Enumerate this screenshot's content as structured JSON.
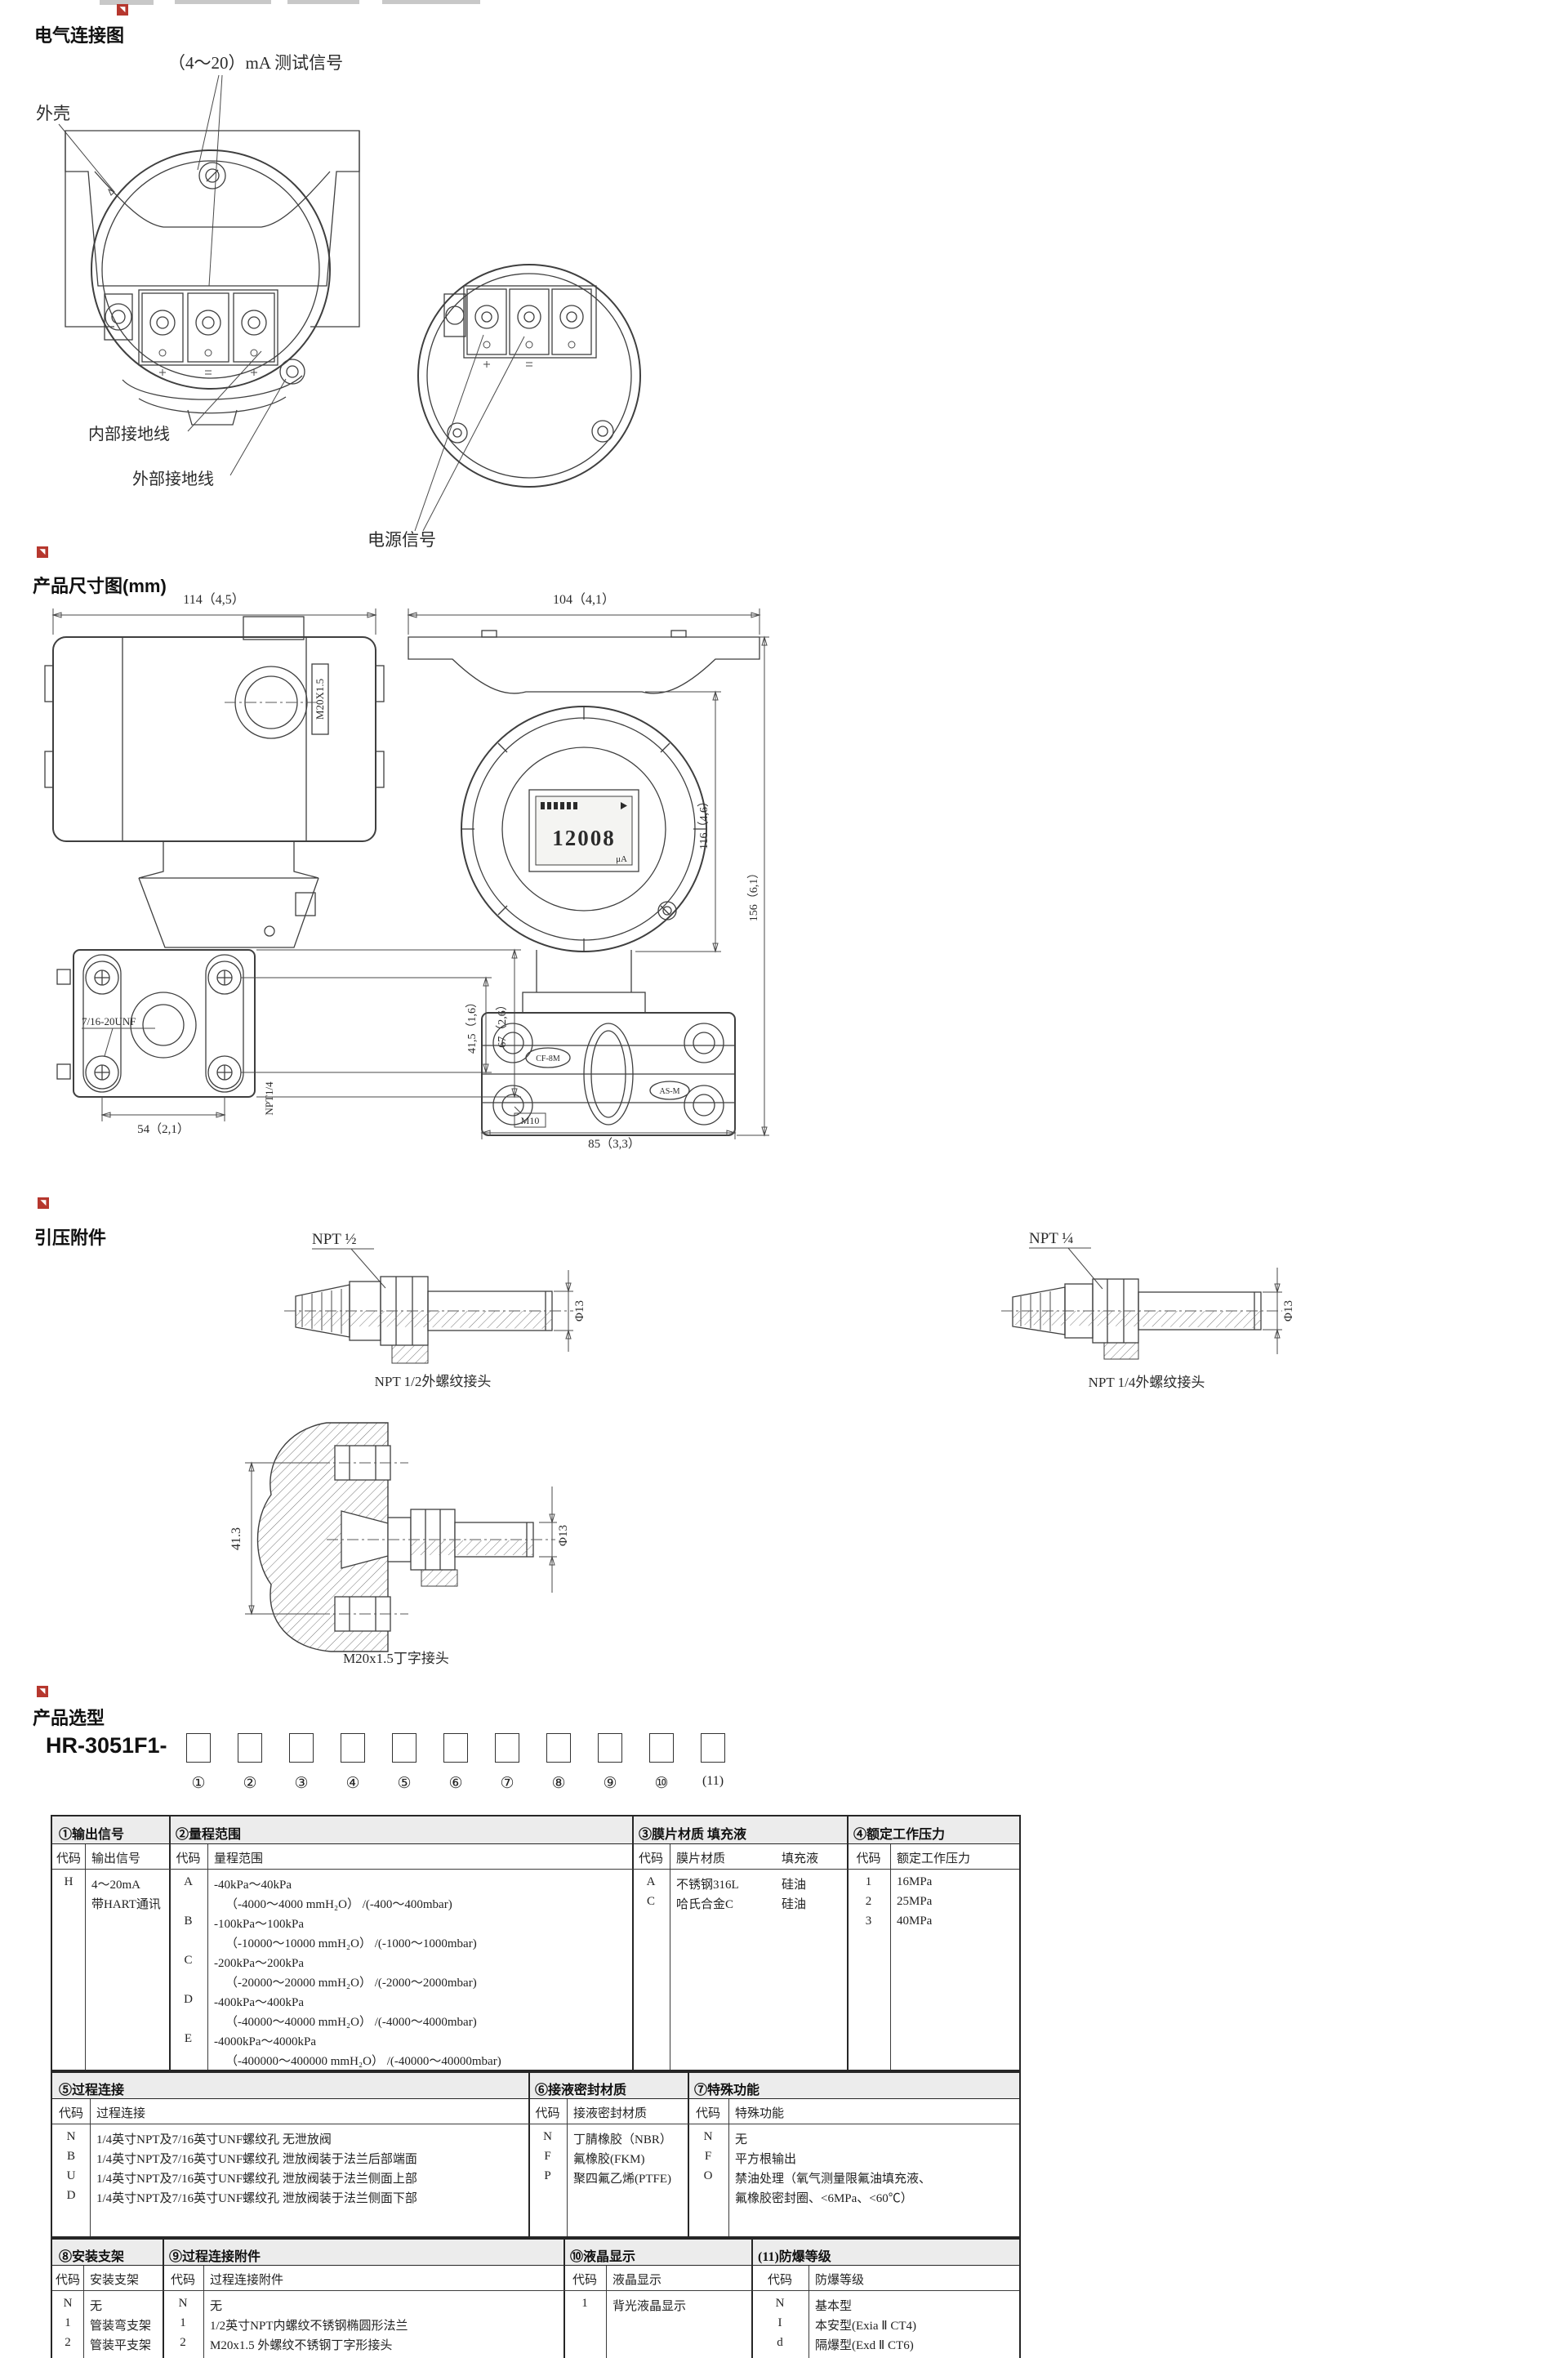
{
  "electrical": {
    "section_title": "电气连接图",
    "test_signal_label": "（4～20）mA 测试信号",
    "housing_label": "外壳",
    "internal_ground_label": "内部接地线",
    "external_ground_label": "外部接地线",
    "power_signal_label": "电源信号"
  },
  "dimensions": {
    "section_title": "产品尺寸图(mm)",
    "left_view": {
      "top_width": "114（4,5）",
      "conduit_thread": "M20X1.5",
      "bolt_thread": "7/16-20UNF",
      "bolt_pitch_v": "41,5（1,6）",
      "flange_height": "67（2,6）",
      "drain_thread": "NPT1/4",
      "bolt_pitch_h": "54（2,1）"
    },
    "right_view": {
      "top_width": "104（4,1）",
      "lcd_value": "12008",
      "lcd_unit": "μA",
      "body_height": "116（4,6）",
      "total_height": "156（6,1）",
      "mark_left": "CF-8M",
      "mark_right": "AS-M",
      "vent_thread": "M10",
      "flange_width": "85（3,3）"
    }
  },
  "fittings": {
    "section_title": "引压附件",
    "npt12": {
      "thread_label": "NPT ½",
      "dia_label": "Φ13",
      "caption": "NPT 1/2外螺纹接头"
    },
    "npt14": {
      "thread_label": "NPT ¼",
      "dia_label": "Φ13",
      "caption": "NPT 1/4外螺纹接头"
    },
    "m20": {
      "height_label": "41.3",
      "dia_label": "Φ13",
      "caption": "M20x1.5丁字接头"
    }
  },
  "selection": {
    "section_title": "产品选型",
    "model_prefix": "HR-3051F1-",
    "position_labels": [
      "①",
      "②",
      "③",
      "④",
      "⑤",
      "⑥",
      "⑦",
      "⑧",
      "⑨",
      "⑩",
      "(11)"
    ],
    "code_header": "代码",
    "block1": {
      "t1": {
        "title": "①输出信号",
        "col": "输出信号",
        "rows": [
          {
            "code": "H",
            "lines": [
              "4～20mA",
              "带HART通讯"
            ]
          }
        ]
      },
      "t2": {
        "title": "②量程范围",
        "col": "量程范围",
        "rows": [
          {
            "code": "A",
            "lines": [
              "-40kPa～40kPa",
              "（-4000～4000 mmH₂O） /(-400～400mbar)"
            ]
          },
          {
            "code": "B",
            "lines": [
              "-100kPa～100kPa",
              "（-10000～10000 mmH₂O） /(-1000～1000mbar)"
            ]
          },
          {
            "code": "C",
            "lines": [
              "-200kPa～200kPa",
              "（-20000～20000 mmH₂O） /(-2000～2000mbar)"
            ]
          },
          {
            "code": "D",
            "lines": [
              "-400kPa～400kPa",
              "（-40000～40000 mmH₂O） /(-4000～4000mbar)"
            ]
          },
          {
            "code": "E",
            "lines": [
              "-4000kPa～4000kPa",
              "（-400000～400000 mmH₂O） /(-40000～40000mbar)"
            ]
          }
        ]
      },
      "t3": {
        "title": "③膜片材质  填充液",
        "col": "膜片材质",
        "col2": "填充液",
        "rows": [
          {
            "code": "A",
            "material": "不锈钢316L",
            "fill": "硅油"
          },
          {
            "code": "C",
            "material": "哈氏合金C",
            "fill": "硅油"
          }
        ]
      },
      "t4": {
        "title": "④额定工作压力",
        "col": "额定工作压力",
        "rows": [
          {
            "code": "1",
            "value": "16MPa"
          },
          {
            "code": "2",
            "value": "25MPa"
          },
          {
            "code": "3",
            "value": "40MPa"
          }
        ]
      }
    },
    "block2": {
      "t5": {
        "title": "⑤过程连接",
        "col": "过程连接",
        "rows": [
          {
            "code": "N",
            "value": "1/4英寸NPT及7/16英寸UNF螺纹孔 无泄放阀"
          },
          {
            "code": "B",
            "value": "1/4英寸NPT及7/16英寸UNF螺纹孔 泄放阀装于法兰后部端面"
          },
          {
            "code": "U",
            "value": "1/4英寸NPT及7/16英寸UNF螺纹孔 泄放阀装于法兰侧面上部"
          },
          {
            "code": "D",
            "value": "1/4英寸NPT及7/16英寸UNF螺纹孔 泄放阀装于法兰侧面下部"
          }
        ]
      },
      "t6": {
        "title": "⑥接液密封材质",
        "col": "接液密封材质",
        "rows": [
          {
            "code": "N",
            "value": "丁腈橡胶（NBR）"
          },
          {
            "code": "F",
            "value": "氟橡胶(FKM)"
          },
          {
            "code": "P",
            "value": "聚四氟乙烯(PTFE)"
          }
        ]
      },
      "t7": {
        "title": "⑦特殊功能",
        "col": "特殊功能",
        "rows": [
          {
            "code": "N",
            "lines": [
              "无"
            ]
          },
          {
            "code": "F",
            "lines": [
              "平方根输出"
            ]
          },
          {
            "code": "O",
            "lines": [
              "禁油处理（氧气测量限氟油填充液、",
              "氟橡胶密封圈、<6MPa、<60℃）"
            ]
          }
        ]
      }
    },
    "block3": {
      "t8": {
        "title": "⑧安装支架",
        "col": "安装支架",
        "rows": [
          {
            "code": "N",
            "value": "无"
          },
          {
            "code": "1",
            "value": "管装弯支架"
          },
          {
            "code": "2",
            "value": "管装平支架"
          }
        ]
      },
      "t9": {
        "title": "⑨过程连接附件",
        "col": "过程连接附件",
        "rows": [
          {
            "code": "N",
            "value": "无"
          },
          {
            "code": "1",
            "value": "1/2英寸NPT内螺纹不锈钢椭圆形法兰"
          },
          {
            "code": "2",
            "value": "M20x1.5 外螺纹不锈钢丁字形接头"
          }
        ]
      },
      "t10": {
        "title": "⑩液晶显示",
        "col": "液晶显示",
        "rows": [
          {
            "code": "1",
            "value": "背光液晶显示"
          }
        ]
      },
      "t11": {
        "title": "(11)防爆等级",
        "col": "防爆等级",
        "rows": [
          {
            "code": "N",
            "value": "基本型"
          },
          {
            "code": "I",
            "value": "本安型(Exia Ⅱ CT4)"
          },
          {
            "code": "d",
            "value": "隔爆型(Exd Ⅱ CT6)"
          }
        ]
      }
    }
  }
}
